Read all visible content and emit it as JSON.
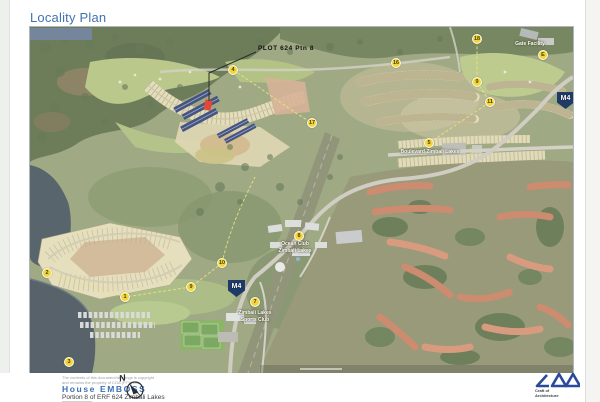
{
  "title": "Locality Plan",
  "map": {
    "plot_label": "PLOT 624 Ptn 8",
    "road_badge": "M4",
    "labels": {
      "gate_facility": "Gate Facility",
      "boulevard": "Boulevard Zimbali Lakes",
      "ocean_club_line1": "Ocean Club",
      "ocean_club_line2": "Zimbali Lakes",
      "sports_club_line1": "Zimbali Lakes",
      "sports_club_line2": "Sports Club"
    },
    "markers": [
      {
        "label": "4"
      },
      {
        "label": "17"
      },
      {
        "label": "16"
      },
      {
        "label": "18"
      },
      {
        "label": "9"
      },
      {
        "label": "11"
      },
      {
        "label": "E"
      },
      {
        "label": "5"
      },
      {
        "label": "8"
      },
      {
        "label": "7"
      },
      {
        "label": "2"
      },
      {
        "label": "1"
      },
      {
        "label": "9"
      },
      {
        "label": "10"
      },
      {
        "label": "3"
      }
    ]
  },
  "footer": {
    "copyright_line1": "The contents of this document/drawings is copyright",
    "copyright_line2": "and remains the property of COA (PTY) Ltd",
    "project_name": "House EMBOSS",
    "project_description": "Portion 8 of ERF 624 Zimbali Lakes",
    "north_label": "N",
    "logo": "LAA",
    "logo_tagline_line1": "Craft of",
    "logo_tagline_line2": "Architecture"
  },
  "colors": {
    "accent_blue": "#3a6fb5",
    "title_blue": "#4173ae",
    "logo_blue": "#2c4a9b",
    "badge_navy": "#1f3a66",
    "marker_yellow": "#f2d63c",
    "plot_red": "#e2301f",
    "water": "#44525d",
    "slate_box": "#75869c"
  }
}
